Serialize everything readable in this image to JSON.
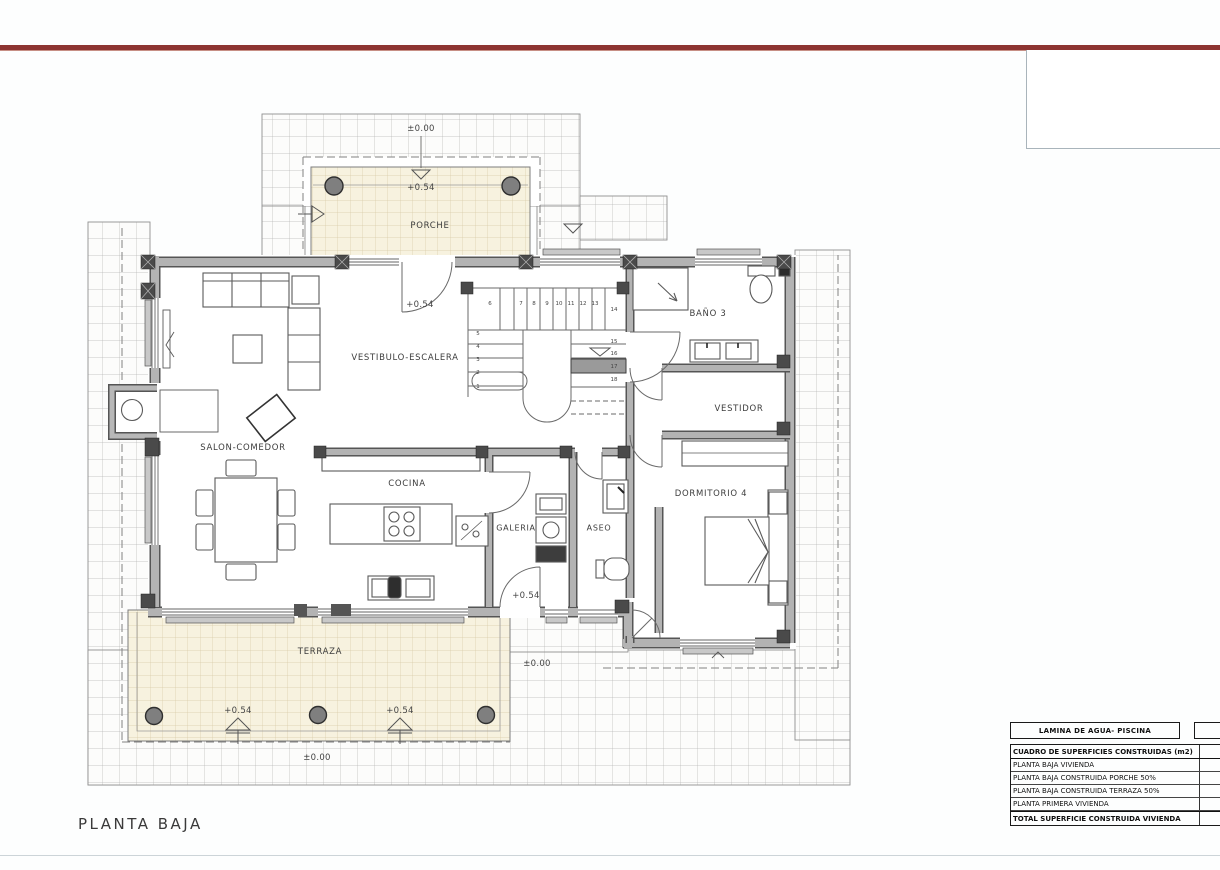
{
  "plan": {
    "title": "PLANTA BAJA",
    "rooms": {
      "porche": "PORCHE",
      "vestibulo": "VESTIBULO-ESCALERA",
      "salon": "SALON-COMEDOR",
      "cocina": "COCINA",
      "galeria": "GALERIA",
      "aseo": "ASEO",
      "bano": "BAÑO 3",
      "vestidor": "VESTIDOR",
      "dormitorio": "DORMITORIO 4",
      "terraza": "TERRAZA"
    },
    "levels": {
      "zero_top": "±0.00",
      "porche": "+0.54",
      "entrada": "+0.54",
      "galeria": "+0.54",
      "terraza_a": "+0.54",
      "terraza_b": "+0.54",
      "zero_bottom": "±0.00",
      "zero_right": "±0.00"
    },
    "stairs": {
      "numbers": [
        "1",
        "2",
        "3",
        "4",
        "5",
        "6",
        "7",
        "8",
        "9",
        "10",
        "11",
        "12",
        "13",
        "14",
        "15",
        "16",
        "17",
        "18"
      ]
    }
  },
  "areas_table": {
    "pool_row": "LAMINA DE AGUA- PISCINA",
    "header": "CUADRO DE SUPERFICIES CONSTRUIDAS (m2)",
    "rows": [
      "PLANTA BAJA VIVIENDA",
      "PLANTA BAJA CONSTRUIDA PORCHE 50%",
      "PLANTA BAJA CONSTRUIDA TERRAZA 50%",
      "PLANTA PRIMERA VIVIENDA"
    ],
    "total": "TOTAL SUPERFICIE CONSTRUIDA VIVIENDA"
  },
  "colors": {
    "accent_rule": "#8d3431",
    "wall_edge": "#555555",
    "wall_fill": "#b3b3b3",
    "tile_beige": "#f7f2df",
    "grid_line": "#b6b6b6"
  }
}
